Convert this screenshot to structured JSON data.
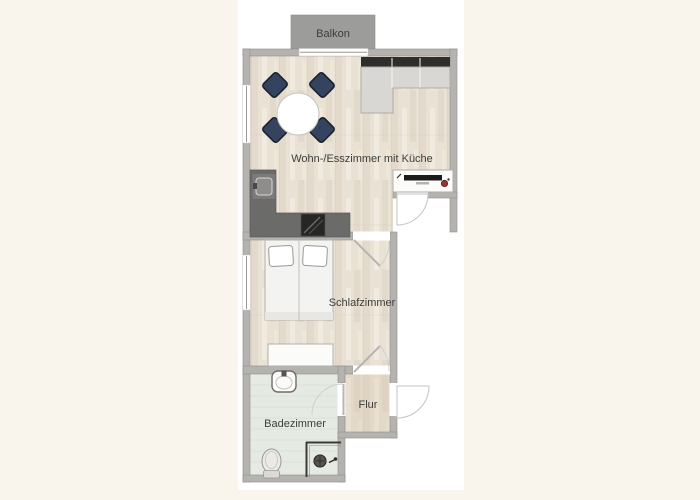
{
  "background": {
    "page": "#faf5ec",
    "plan": "#ffffff"
  },
  "rooms": {
    "balcony": {
      "label": "Balkon"
    },
    "living": {
      "label": "Wohn-/Esszimmer mit Küche"
    },
    "bedroom": {
      "label": "Schlafzimmer"
    },
    "hallway": {
      "label": "Flur"
    },
    "bathroom": {
      "label": "Badezimmer"
    }
  },
  "colors": {
    "wall": "#b5b3b0",
    "balcony_fill": "#9c9c9a",
    "balcony_text": "#454543",
    "wood_base": "#e8e1d4",
    "hall_wood_tint": "#d3c5a9",
    "bath_floor": "#e5eae3",
    "bath_tile_line": "#d5ded3",
    "counter": "#6b6b69",
    "sink_unit": "#7d7b79",
    "stove": "#262624",
    "chair": "#35445e",
    "table": "#ffffff",
    "sofa_seat": "#d9d7d3",
    "sofa_back": "#2e2e2c",
    "sideboard": "#fbfbfa",
    "tv": "#1c1c1a",
    "decor_red": "#993333",
    "bed_mattress": "#f3f3f1",
    "label_text": "#3d3d3b"
  },
  "furniture": [
    "round dining table with four chairs",
    "corner sofa",
    "kitchen counter with sink and stove",
    "sideboard with TV",
    "double bed",
    "dresser",
    "washbasin",
    "toilet",
    "shower"
  ]
}
